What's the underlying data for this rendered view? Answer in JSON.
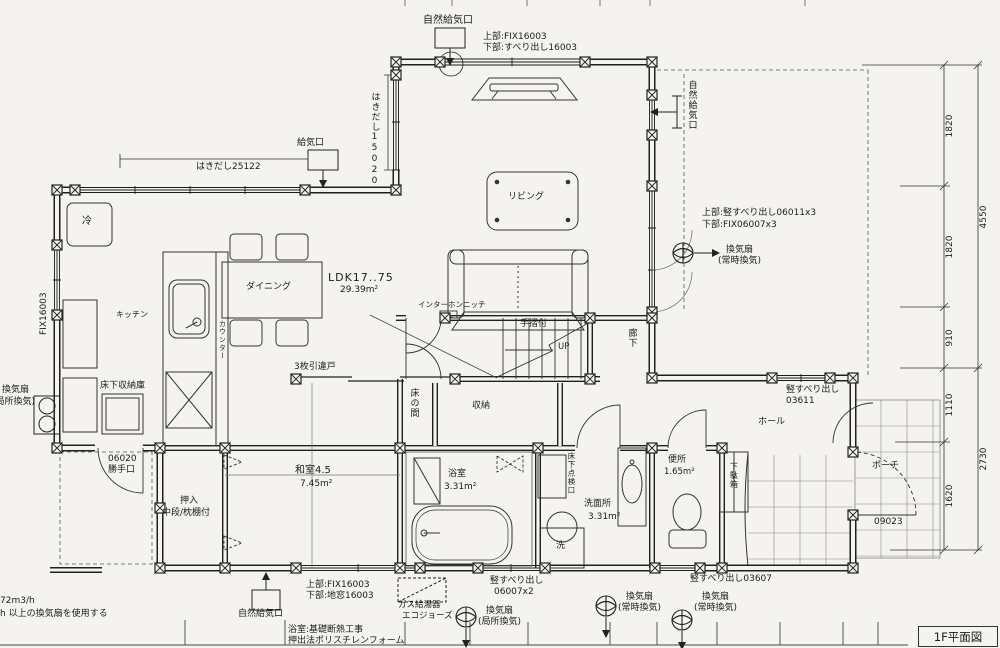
{
  "labels": {
    "natural_vent_top": "自然給気口",
    "win_top_u": "上部:FIX16003",
    "win_top_l": "下部:すべり出し16003",
    "hakidashi_25122": "はきだし25122",
    "kyukiko": "給気口",
    "hakidashi_15020": "はきだし15020",
    "natural_vent_right": "自然給気口",
    "win_right_u": "上部:竪すべり出し06011x3",
    "win_right_l": "下部:FIX06007x3",
    "fan_right_1": "換気扇",
    "fan_right_2": "(常時換気)",
    "win_03611_1": "竪すべり出し",
    "win_03611_2": "03611",
    "porch": "ポーチ",
    "d_09023": "09023",
    "hall": "ホール",
    "corridor": "廊下",
    "living": "リビング",
    "ldk": "LDK17..75",
    "ldk_area": "29.39m²",
    "dining": "ダイニング",
    "interphone": "インターホンニッチ",
    "handrail": "手摺付",
    "up": "UP",
    "kitchen": "キッチン",
    "counter": "カウンター",
    "fridge": "冷",
    "underfloor_storage": "床下収納庫",
    "sliding3": "3枚引違戸",
    "fix16003_left": "FIX16003",
    "fan_left_1": "換気扇",
    "fan_left_2": "(局所換気)",
    "washitsu": "和室4.5",
    "washitsu_area": "7.45m²",
    "oshiire_1": "押入",
    "oshiire_2": "中段/枕棚付",
    "tokonoma": "床の間",
    "storage": "収納",
    "katte_1": "06020",
    "katte_2": "勝手口",
    "bath": "浴室",
    "bath_area": "3.31m²",
    "wash": "洗面所",
    "wash_area": "3.31m²",
    "laundry": "洗",
    "underfloor_hatch": "床下点検口",
    "toilet": "便所",
    "toilet_area": "1.65m²",
    "shoe": "下駄箱",
    "win_bottom_u": "上部:FIX16003",
    "win_bottom_l": "下部:地窓16003",
    "gas_1": "ガス給湯器",
    "gas_2": "エコジョーズ",
    "win_06007_1": "竪すべり出し",
    "win_06007_2": "06007x2",
    "fan_b1_1": "換気扇",
    "fan_b1_2": "(局所換気)",
    "win_03607": "竪すべり出し03607",
    "fan_b2_1": "換気扇",
    "fan_b2_2": "(常時換気)",
    "fan_b3_1": "換気扇",
    "fan_b3_2": "(常時換気)",
    "natural_vent_bottom": "自然給気口",
    "note_vent_1": "72m3/h",
    "note_vent_2": "h 以上の換気扇を使用する",
    "note_bath_1": "浴室:基礎断熱工事",
    "note_bath_2": "押出法ポリスチレンフォーム"
  },
  "dimensions": {
    "right_inner": [
      "1820",
      "1820",
      "910",
      "1110",
      "1620"
    ],
    "right_outer": [
      "4550",
      "2730"
    ]
  },
  "title_block": {
    "title": "1F平面図"
  }
}
